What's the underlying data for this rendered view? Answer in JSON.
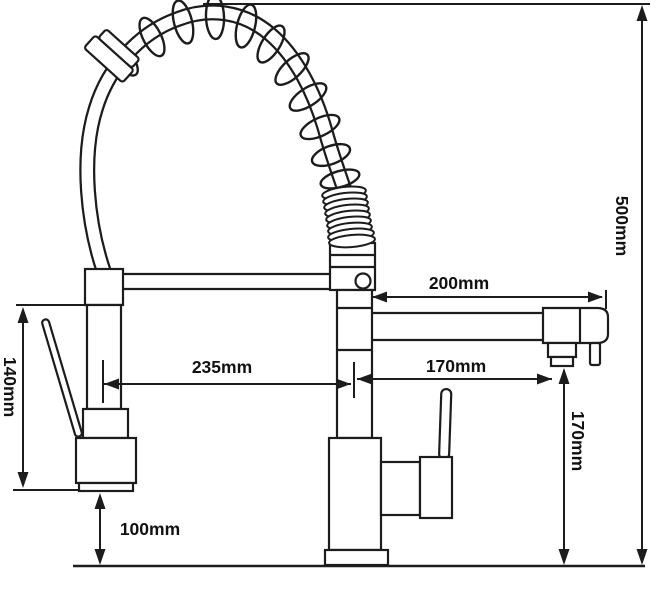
{
  "diagram": {
    "title": "Pull-out spring kitchen faucet dimension drawing",
    "unit": "mm",
    "ink_color": "#1c1c1c",
    "background_color": "#ffffff",
    "dimensions": [
      {
        "id": "total-height",
        "label": "500mm",
        "value": 500,
        "orientation": "vertical"
      },
      {
        "id": "spout-reach",
        "label": "200mm",
        "value": 200,
        "orientation": "horizontal"
      },
      {
        "id": "spray-to-body",
        "label": "235mm",
        "value": 235,
        "orientation": "horizontal"
      },
      {
        "id": "body-to-spout-end",
        "label": "170mm",
        "value": 170,
        "orientation": "horizontal"
      },
      {
        "id": "spout-outlet-height",
        "label": "170mm",
        "value": 170,
        "orientation": "vertical"
      },
      {
        "id": "spray-head-height",
        "label": "140mm",
        "value": 140,
        "orientation": "vertical"
      },
      {
        "id": "spray-head-clearance",
        "label": "100mm",
        "value": 100,
        "orientation": "vertical"
      }
    ]
  }
}
